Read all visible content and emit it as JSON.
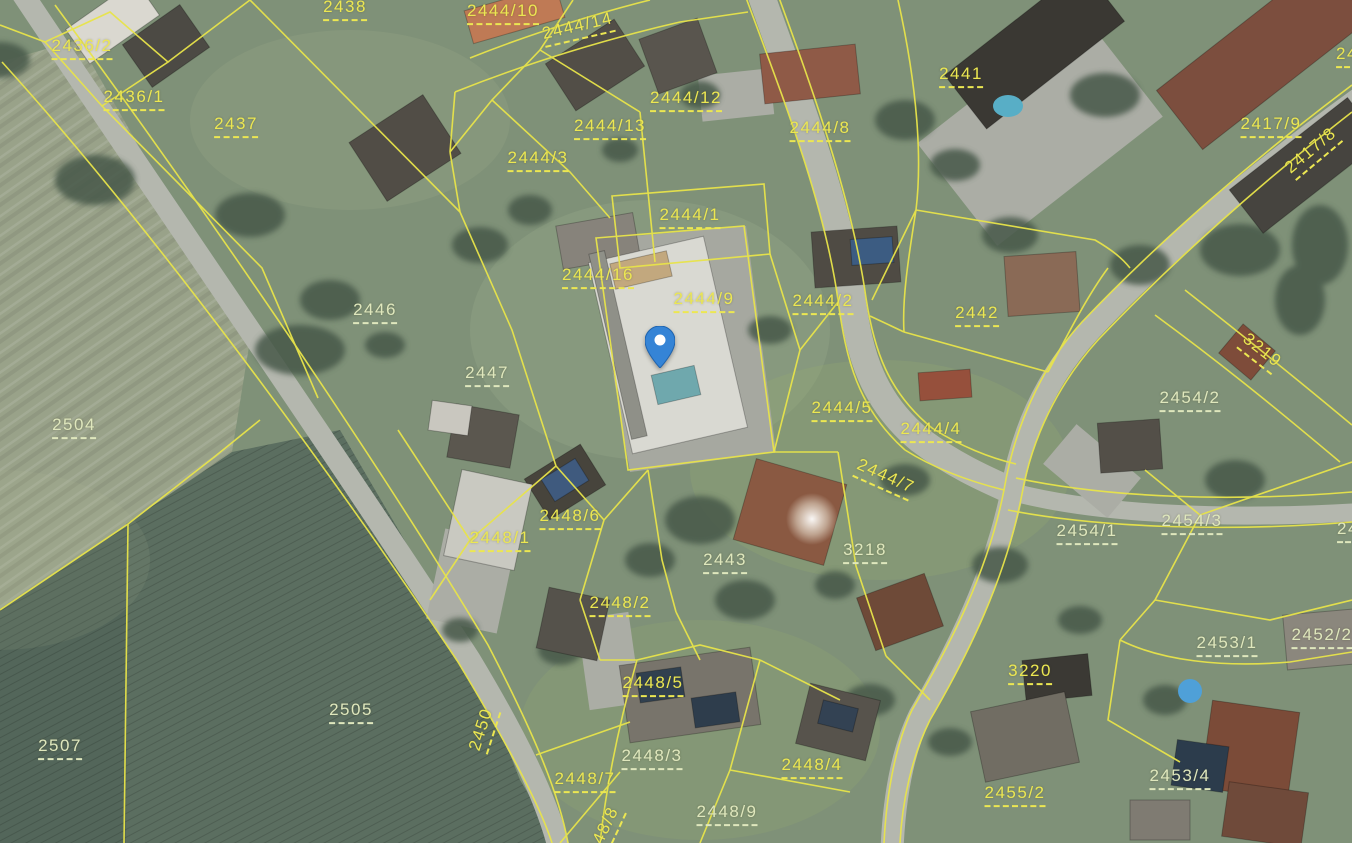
{
  "map": {
    "type": "aerial-cadastral-map",
    "boundary_color": "#e8e44a",
    "label_color_bright": "#ece752",
    "label_color_pale": "#dfe7bd",
    "marker": {
      "name": "location-pin",
      "x": 660,
      "y": 368,
      "color_body": "#3584d6",
      "color_shade": "#1f63ad",
      "color_hole": "#ffffff"
    },
    "parcels": [
      {
        "label": "2436/2",
        "x": 82,
        "y": 48,
        "rot": 0,
        "tone": "bright"
      },
      {
        "label": "2436/1",
        "x": 134,
        "y": 99,
        "rot": 0,
        "tone": "bright"
      },
      {
        "label": "2437",
        "x": 236,
        "y": 126,
        "rot": 0,
        "tone": "bright"
      },
      {
        "label": "2438",
        "x": 345,
        "y": 9,
        "rot": 0,
        "tone": "bright"
      },
      {
        "label": "2444/10",
        "x": 503,
        "y": 13,
        "rot": 0,
        "tone": "bright"
      },
      {
        "label": "2444/14",
        "x": 578,
        "y": 28,
        "rot": -13,
        "tone": "bright"
      },
      {
        "label": "2444/12",
        "x": 686,
        "y": 100,
        "rot": 0,
        "tone": "bright"
      },
      {
        "label": "2444/13",
        "x": 610,
        "y": 128,
        "rot": 0,
        "tone": "bright"
      },
      {
        "label": "2444/3",
        "x": 538,
        "y": 160,
        "rot": 0,
        "tone": "bright"
      },
      {
        "label": "2444/8",
        "x": 820,
        "y": 130,
        "rot": 0,
        "tone": "bright"
      },
      {
        "label": "2441",
        "x": 961,
        "y": 76,
        "rot": 0,
        "tone": "bright"
      },
      {
        "label": "2417/9",
        "x": 1271,
        "y": 126,
        "rot": 0,
        "tone": "bright"
      },
      {
        "label": "2417/8",
        "x": 1312,
        "y": 152,
        "rot": -40,
        "tone": "bright"
      },
      {
        "label": "24",
        "x": 1347,
        "y": 56,
        "rot": 0,
        "tone": "bright"
      },
      {
        "label": "2444/1",
        "x": 690,
        "y": 217,
        "rot": 0,
        "tone": "bright"
      },
      {
        "label": "2444/16",
        "x": 598,
        "y": 277,
        "rot": 0,
        "tone": "bright"
      },
      {
        "label": "2444/9",
        "x": 704,
        "y": 301,
        "rot": 0,
        "tone": "bright"
      },
      {
        "label": "2444/2",
        "x": 823,
        "y": 303,
        "rot": 0,
        "tone": "bright"
      },
      {
        "label": "2442",
        "x": 977,
        "y": 315,
        "rot": 0,
        "tone": "bright"
      },
      {
        "label": "2446",
        "x": 375,
        "y": 312,
        "rot": 0,
        "tone": "pale"
      },
      {
        "label": "3219",
        "x": 1261,
        "y": 352,
        "rot": 38,
        "tone": "bright"
      },
      {
        "label": "2454/2",
        "x": 1190,
        "y": 400,
        "rot": 0,
        "tone": "pale"
      },
      {
        "label": "2447",
        "x": 487,
        "y": 375,
        "rot": 0,
        "tone": "pale"
      },
      {
        "label": "2504",
        "x": 74,
        "y": 427,
        "rot": 0,
        "tone": "pale"
      },
      {
        "label": "2444/5",
        "x": 842,
        "y": 410,
        "rot": 0,
        "tone": "bright"
      },
      {
        "label": "2444/4",
        "x": 931,
        "y": 431,
        "rot": 0,
        "tone": "bright"
      },
      {
        "label": "2444/7",
        "x": 885,
        "y": 478,
        "rot": 24,
        "tone": "bright"
      },
      {
        "label": "2448/6",
        "x": 570,
        "y": 518,
        "rot": 0,
        "tone": "bright"
      },
      {
        "label": "2448/1",
        "x": 500,
        "y": 540,
        "rot": 0,
        "tone": "bright"
      },
      {
        "label": "2454/1",
        "x": 1087,
        "y": 533,
        "rot": 0,
        "tone": "pale"
      },
      {
        "label": "2454/3",
        "x": 1192,
        "y": 523,
        "rot": 0,
        "tone": "pale"
      },
      {
        "label": "24",
        "x": 1348,
        "y": 531,
        "rot": 0,
        "tone": "pale"
      },
      {
        "label": "2443",
        "x": 725,
        "y": 562,
        "rot": 0,
        "tone": "pale"
      },
      {
        "label": "3218",
        "x": 865,
        "y": 552,
        "rot": 0,
        "tone": "pale"
      },
      {
        "label": "2448/2",
        "x": 620,
        "y": 605,
        "rot": 0,
        "tone": "bright"
      },
      {
        "label": "2453/1",
        "x": 1227,
        "y": 645,
        "rot": 0,
        "tone": "pale"
      },
      {
        "label": "2452/2",
        "x": 1322,
        "y": 637,
        "rot": 0,
        "tone": "pale"
      },
      {
        "label": "2505",
        "x": 351,
        "y": 712,
        "rot": 0,
        "tone": "pale"
      },
      {
        "label": "2507",
        "x": 60,
        "y": 748,
        "rot": 0,
        "tone": "pale"
      },
      {
        "label": "2450",
        "x": 483,
        "y": 730,
        "rot": -72,
        "tone": "bright"
      },
      {
        "label": "3220",
        "x": 1030,
        "y": 673,
        "rot": 0,
        "tone": "bright"
      },
      {
        "label": "2448/5",
        "x": 653,
        "y": 685,
        "rot": 0,
        "tone": "bright"
      },
      {
        "label": "2448/3",
        "x": 652,
        "y": 758,
        "rot": 0,
        "tone": "pale"
      },
      {
        "label": "2448/7",
        "x": 585,
        "y": 781,
        "rot": 0,
        "tone": "bright"
      },
      {
        "label": "2448/4",
        "x": 812,
        "y": 767,
        "rot": 0,
        "tone": "bright"
      },
      {
        "label": "2448/9",
        "x": 727,
        "y": 814,
        "rot": 0,
        "tone": "pale"
      },
      {
        "label": "2448/8",
        "x": 603,
        "y": 836,
        "rot": -65,
        "tone": "bright"
      },
      {
        "label": "2455/2",
        "x": 1015,
        "y": 795,
        "rot": 0,
        "tone": "bright"
      },
      {
        "label": "2453/4",
        "x": 1180,
        "y": 778,
        "rot": 0,
        "tone": "pale"
      }
    ]
  }
}
